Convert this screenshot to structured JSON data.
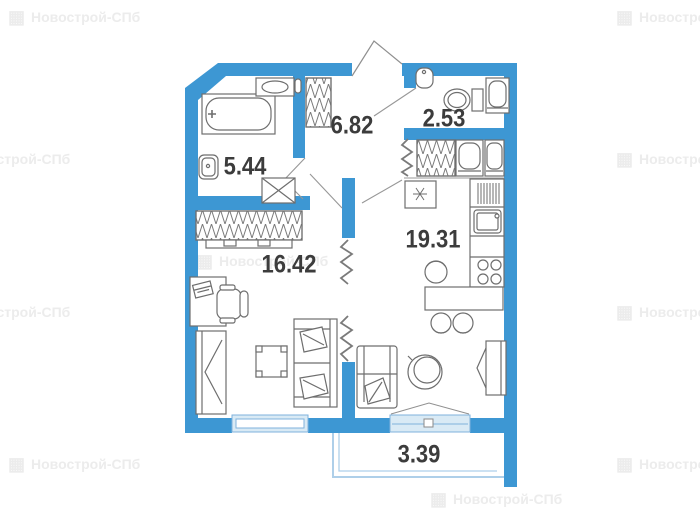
{
  "watermark": {
    "text": "Новострой-СПб",
    "icon": "building-icon"
  },
  "plan": {
    "colors": {
      "wall": "#3d97d3",
      "window_fill": "#d9eaf5",
      "window_stroke": "#7fb2dc",
      "balcony_stroke": "#aecfe9",
      "label": "#3c3c3c"
    },
    "rooms": [
      {
        "name": "bathroom",
        "area": "5.44"
      },
      {
        "name": "hallway",
        "area": "6.82"
      },
      {
        "name": "toilet",
        "area": "2.53"
      },
      {
        "name": "bedroom",
        "area": "16.42"
      },
      {
        "name": "kitchen-living-room",
        "area": "19.31"
      },
      {
        "name": "balcony",
        "area": "3.39"
      }
    ]
  }
}
